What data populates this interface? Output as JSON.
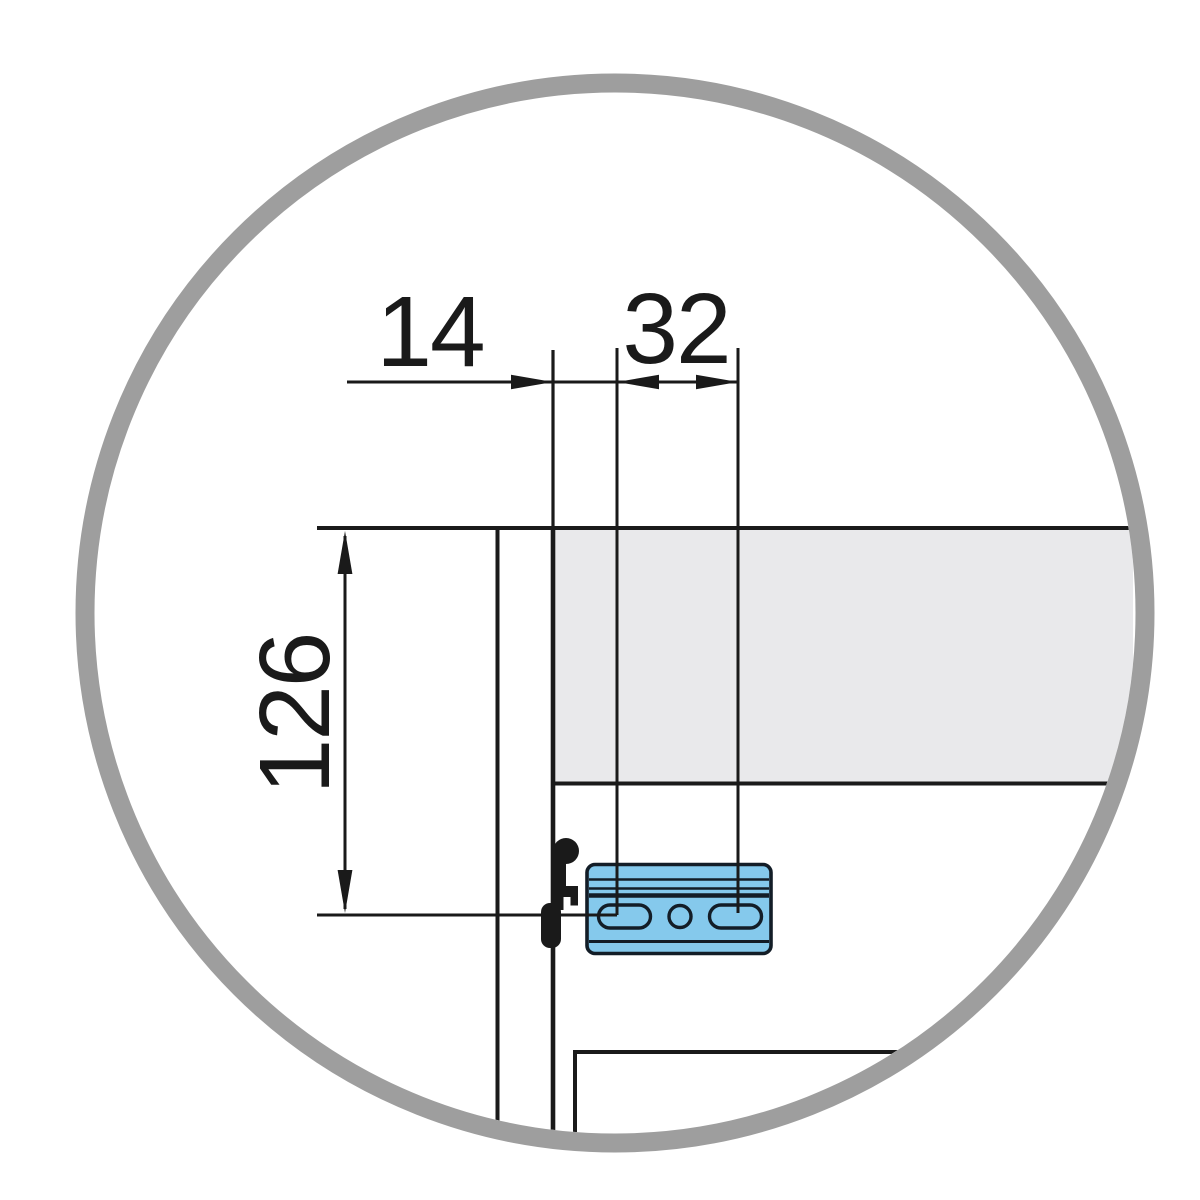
{
  "diagram": {
    "dimension_labels": {
      "front_offset": "14",
      "hole_spacing": "32",
      "vertical_offset": "126"
    },
    "colors": {
      "background": "#ffffff",
      "ring": "#9e9e9e",
      "line": "#1a1a1a",
      "panel_fill": "#e9e9eb",
      "plate_fill": "#85c9ec",
      "plate_stroke": "#131d27"
    }
  }
}
